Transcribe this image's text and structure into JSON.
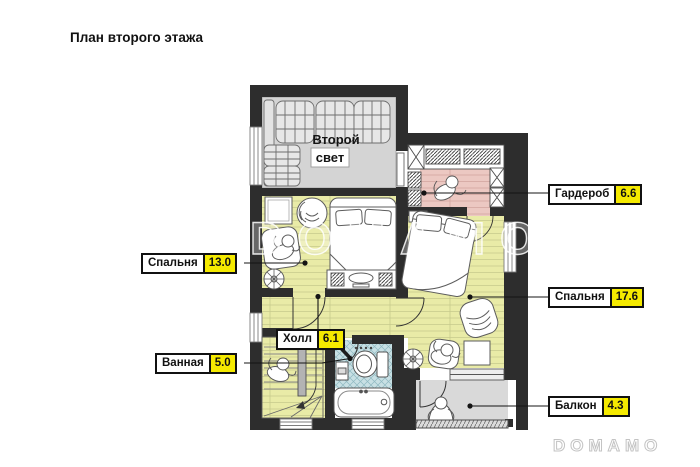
{
  "title": "План второго этажа",
  "watermarks": {
    "center": "DOMAMO",
    "corner": "DOMAMO"
  },
  "plan": {
    "second_light": {
      "line1": "Второй",
      "line2": "свет"
    }
  },
  "callouts": {
    "wardrobe": {
      "name": "Гардероб",
      "area": "6.6"
    },
    "bedroom_left": {
      "name": "Спальня",
      "area": "13.0"
    },
    "bedroom_right": {
      "name": "Спальня",
      "area": "17.6"
    },
    "hall": {
      "name": "Холл",
      "area": "6.1"
    },
    "bathroom": {
      "name": "Ванная",
      "area": "5.0"
    },
    "balcony": {
      "name": "Балкон",
      "area": "4.3"
    }
  },
  "colors": {
    "wall": "#2d2d2d",
    "floor_yellow": "#e9ebа7",
    "floor_pink": "#ecc8c2",
    "floor_gray": "#d4d4d4",
    "tile_blue": "#c8e0e4",
    "area_highlight": "#f5ea00"
  }
}
